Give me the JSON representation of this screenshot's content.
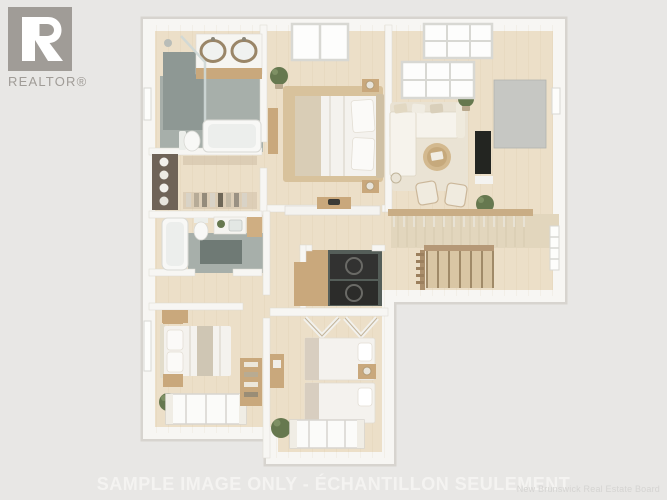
{
  "canvas": {
    "width": 667,
    "height": 500
  },
  "branding": {
    "realtor_logo_text": "REALTOR®",
    "logo_color": "#a09c97"
  },
  "caption": {
    "text": "SAMPLE IMAGE ONLY - ÉCHANTILLON SEULEMENT",
    "color": "#f4f3f1"
  },
  "credit": {
    "text": "New Brunswick Real Estate Board",
    "color": "#d5d4d2"
  },
  "floorplan": {
    "type": "3d-top-down-render",
    "rooms": [
      {
        "name": "ensuite-bathroom",
        "features": [
          "double-vanity-sinks",
          "glass-shower",
          "bathtub",
          "toilet",
          "window"
        ]
      },
      {
        "name": "walk-in-closet",
        "features": [
          "shelving-unit",
          "towels",
          "clothes-rail"
        ]
      },
      {
        "name": "second-bathroom",
        "features": [
          "bathtub",
          "toilet",
          "vanity-sink",
          "bath-mat",
          "plant"
        ]
      },
      {
        "name": "master-bedroom",
        "features": [
          "double-bed",
          "nightstands",
          "lamps",
          "skylight",
          "jute-rug",
          "bench",
          "plant"
        ]
      },
      {
        "name": "living-room",
        "features": [
          "sectional-sofa",
          "round-coffee-table",
          "accent-chairs",
          "tv",
          "media-wall",
          "skylights",
          "railing",
          "plants",
          "floor-lamp"
        ]
      },
      {
        "name": "stairwell",
        "features": [
          "staircase",
          "handrail",
          "window"
        ]
      },
      {
        "name": "hallway",
        "features": [
          "console-table",
          "half-wall",
          "cabinet"
        ]
      },
      {
        "name": "laundry-closet",
        "features": [
          "washer",
          "dryer"
        ]
      },
      {
        "name": "bedroom-2",
        "features": [
          "double-bed",
          "nightstands",
          "window",
          "curtained-window",
          "plant",
          "closet-shelves"
        ]
      },
      {
        "name": "bedroom-3",
        "features": [
          "twin-bed",
          "twin-bed",
          "shared-nightstand",
          "open-closet",
          "desk",
          "curtained-window",
          "plant"
        ]
      }
    ],
    "colors": {
      "background": "#e8e7e5",
      "logo": "#a09c97",
      "caption": "#f4f3f1",
      "credit": "#d5d4d2",
      "wall": "#f7f6f3",
      "wall_shadow": "#d7d4cf",
      "floor_wood": "#ecdfc8",
      "plank_line": "#bfa478",
      "tile_gray": "#a7afaa",
      "tile_dark": "#6f7a75",
      "shower_gray": "#8e9894",
      "rug_jute": "#d8c29c",
      "rug_light": "#eae3d4",
      "wood_furniture": "#c9a87c",
      "linen_white": "#f4f2ee",
      "linen_beige": "#d9cdb6",
      "plant_green": "#66784f",
      "appliance_dark": "#323231",
      "stair_wood": "#d9c6a4",
      "stair_rail": "#b59876",
      "panel_wood": "#e2d6bd",
      "tv_black": "#232521",
      "media_gray": "#c6c7c3",
      "fixture_white": "#f8f8f6"
    }
  }
}
